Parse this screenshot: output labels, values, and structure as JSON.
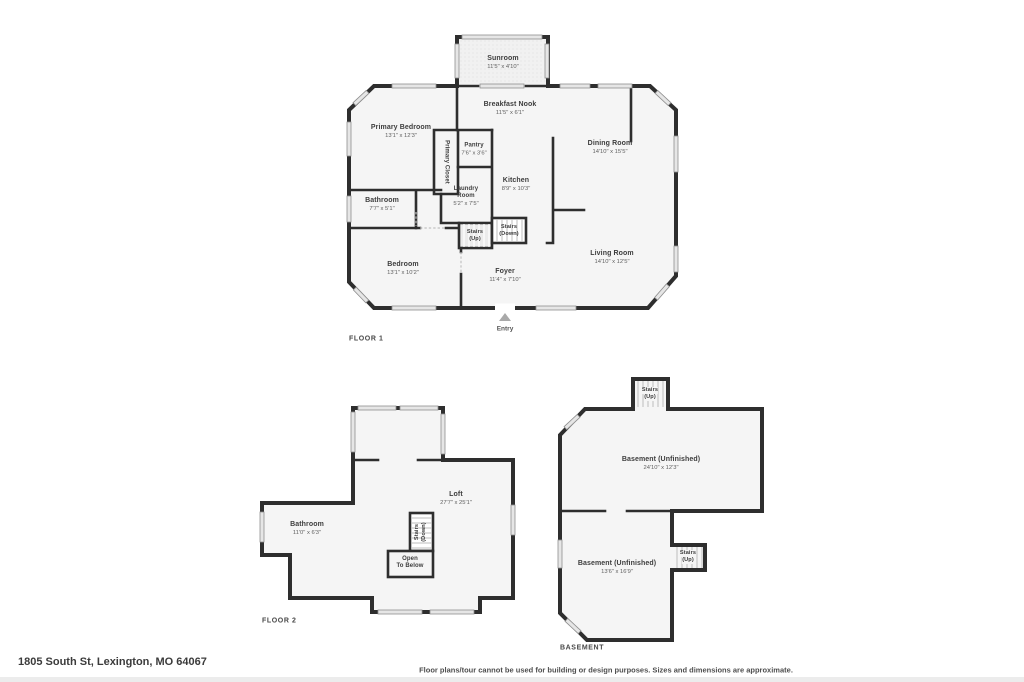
{
  "colors": {
    "wall": "#2e2e2e",
    "room": "#f5f5f5",
    "window_fill": "#e6e6e6",
    "window_edge": "#8f8f8f",
    "label": "#3d3d3d",
    "dim": "#5f5f5f",
    "floor_label": "#474747",
    "entry": "#a9a9a9",
    "tread": "#bdbdbd",
    "stair_fill": "#ebebeb",
    "door": "#c2c2c2",
    "footer_text": "#4e4e4e",
    "address": "#3b3b3b"
  },
  "footer": {
    "address": "1805 South St, Lexington, MO 64067",
    "disclaimer": "Floor plans/tour cannot be used for building or design purposes. Sizes and dimensions are approximate."
  },
  "floor1": {
    "label": "FLOOR 1",
    "entry": "Entry",
    "rooms": {
      "sunroom": {
        "name": "Sunroom",
        "dims": "11'5\" x 4'10\""
      },
      "breakfast": {
        "name": "Breakfast Nook",
        "dims": "11'5\" x 6'1\""
      },
      "primary_bedroom": {
        "name": "Primary Bedroom",
        "dims": "13'1\" x 12'3\""
      },
      "primary_closet": {
        "name": "Primary Closet"
      },
      "pantry": {
        "name": "Pantry",
        "dims": "7'6\" x 3'6\""
      },
      "dining": {
        "name": "Dining Room",
        "dims": "14'10\" x 15'5\""
      },
      "kitchen": {
        "name": "Kitchen",
        "dims": "8'9\" x 10'3\""
      },
      "laundry": {
        "lines": [
          "Laundry",
          "Room"
        ],
        "dims": "5'2\" x 7'5\""
      },
      "bathroom": {
        "name": "Bathroom",
        "dims": "7'7\" x 5'1\""
      },
      "stairs_up": {
        "lines": [
          "Stairs",
          "(Up)"
        ]
      },
      "stairs_down": {
        "lines": [
          "Stairs",
          "(Down)"
        ]
      },
      "bedroom": {
        "name": "Bedroom",
        "dims": "13'1\" x 10'2\""
      },
      "foyer": {
        "name": "Foyer",
        "dims": "11'4\" x 7'10\""
      },
      "living": {
        "name": "Living Room",
        "dims": "14'10\" x 12'5\""
      }
    }
  },
  "floor2": {
    "label": "FLOOR 2",
    "rooms": {
      "bathroom": {
        "name": "Bathroom",
        "dims": "11'0\" x 6'3\""
      },
      "loft": {
        "name": "Loft",
        "dims": "27'7\" x 25'1\""
      },
      "stairs_down": {
        "lines": [
          "Stairs",
          "(Down)"
        ]
      },
      "open_below": {
        "lines": [
          "Open",
          "To Below"
        ]
      }
    }
  },
  "basement": {
    "label": "BASEMENT",
    "rooms": {
      "stairs_top": {
        "lines": [
          "Stairs",
          "(Up)"
        ]
      },
      "upper": {
        "name": "Basement (Unfinished)",
        "dims": "24'10\" x 12'3\""
      },
      "lower": {
        "name": "Basement (Unfinished)",
        "dims": "13'6\" x 16'9\""
      },
      "stairs_right": {
        "lines": [
          "Stairs",
          "(Up)"
        ]
      }
    }
  }
}
